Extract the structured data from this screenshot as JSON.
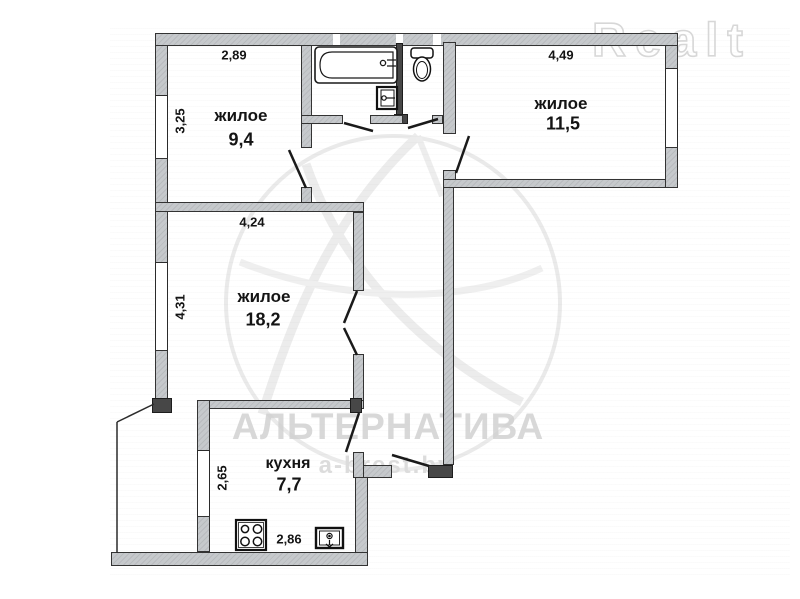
{
  "plan": {
    "rooms": [
      {
        "name": "жилое",
        "area": "9,4",
        "dim_top": "2,89",
        "dim_side": "3,25"
      },
      {
        "name": "жилое",
        "area": "11,5",
        "dim_top": "4,49"
      },
      {
        "name": "жилое",
        "area": "18,2",
        "dim_top": "4,24",
        "dim_side": "4,31"
      },
      {
        "name": "кухня",
        "area": "7,7",
        "dim_side": "2,65",
        "dim_bottom": "2,86"
      }
    ],
    "fixtures": [
      "bathtub",
      "wash-basin",
      "toilet",
      "stove",
      "kitchen-sink"
    ]
  },
  "watermarks": {
    "brand": "Realt",
    "agency": "АЛЬТЕРНАТИВА",
    "website": "a-brest.by"
  }
}
